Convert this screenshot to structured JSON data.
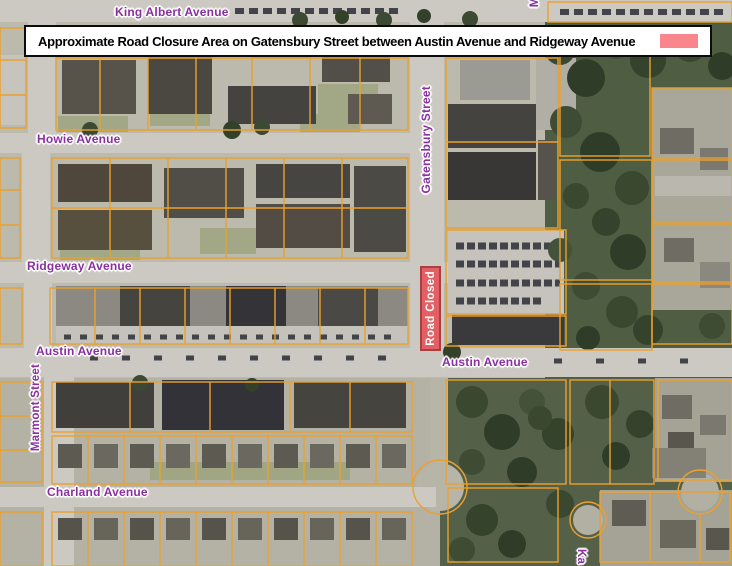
{
  "banner": {
    "text": "Approximate Road Closure Area on Gatensbury Street between Austin Avenue and Ridgeway Avenue"
  },
  "road_closed_marker": {
    "label": "Road Closed"
  },
  "street_labels": {
    "king_albert": "King Albert Avenue",
    "howie": "Howie Avenue",
    "gatensbury": "Gatensbury Street",
    "ridgeway": "Ridgeway Avenue",
    "austin_west": "Austin Avenue",
    "austin_east": "Austin Avenue",
    "marmont": "Marmont Street",
    "charland": "Charland Avenue",
    "partial_top": "M",
    "partial_bottom": "Ka"
  },
  "colors": {
    "street_label": "#8a2fa2",
    "parcel_line": "#eda02c",
    "closure_fill": "#e4575b",
    "closure_border": "#a83338",
    "closure_swatch": "#f9868c"
  }
}
